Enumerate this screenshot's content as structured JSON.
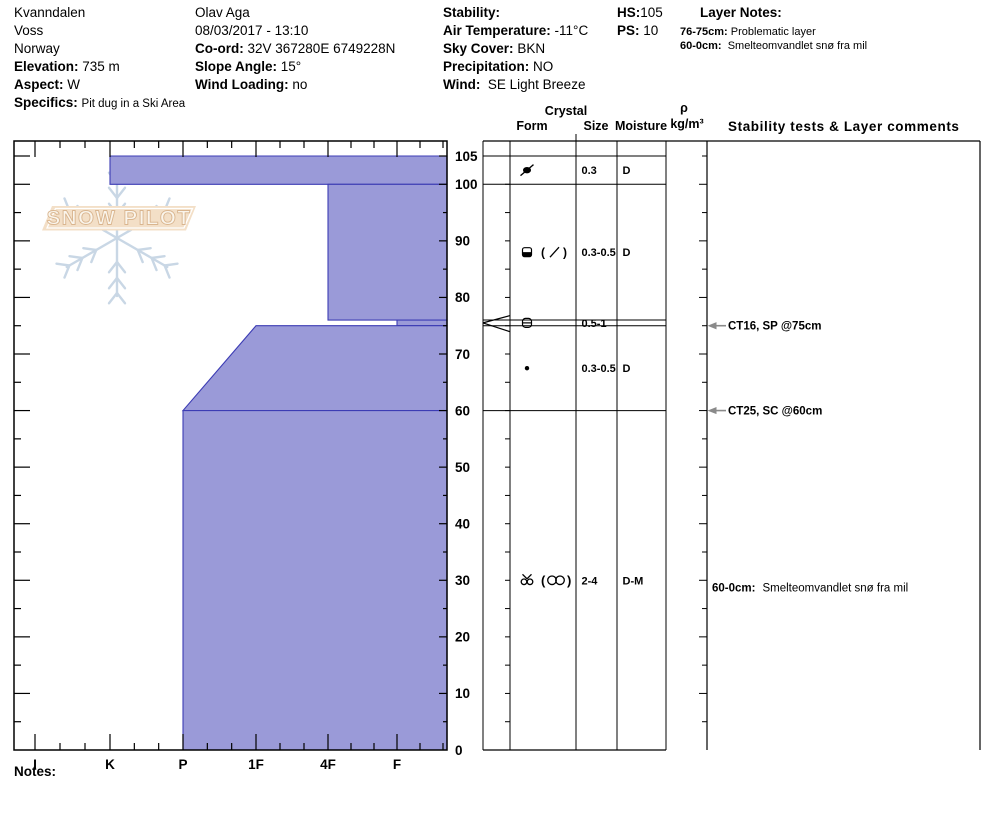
{
  "header": {
    "col1": {
      "line1": "Kvanndalen",
      "line2": "Voss",
      "line3": "Norway",
      "elevation_label": "Elevation:",
      "elevation": "735 m",
      "aspect_label": "Aspect:",
      "aspect": "W",
      "specifics_label": "Specifics:",
      "specifics": "Pit dug in a Ski Area"
    },
    "col2": {
      "observer": "Olav Aga",
      "datetime": "08/03/2017 - 13:10",
      "coord_label": "Co-ord:",
      "coord": "32V 367280E 6749228N",
      "slope_label": "Slope Angle:",
      "slope": "15°",
      "wind_loading_label": "Wind Loading:",
      "wind_loading": "no"
    },
    "col3": {
      "stability_label": "Stability:",
      "air_temp_label": "Air Temperature:",
      "air_temp": "-11°C",
      "sky_label": "Sky Cover:",
      "sky": "BKN",
      "precip_label": "Precipitation:",
      "precip": "NO",
      "wind_label": "Wind:",
      "wind": "SE Light Breeze"
    },
    "col4": {
      "hs_label": "HS:",
      "hs": "105",
      "ps_label": "PS:",
      "ps": "10"
    },
    "layer_notes": {
      "title": "Layer Notes:",
      "items": [
        {
          "range": "76-75cm:",
          "text": "Problematic layer"
        },
        {
          "range": "60-0cm:",
          "text": "Smelteomvandlet snø fra mil"
        }
      ]
    }
  },
  "table_headers": {
    "crystal": "Crystal",
    "form": "Form",
    "size": "Size",
    "moisture": "Moisture",
    "rho": "ρ",
    "rho_units": "kg/m³",
    "comments": "Stability tests & Layer comments"
  },
  "notes_label": "Notes:",
  "chart_data": {
    "type": "area",
    "subtype": "snow-hardness-profile",
    "title": "",
    "ylabel": "depth (cm)",
    "xlabel": "hand hardness",
    "hs_cm": 105,
    "y_ticks": [
      0,
      10,
      20,
      30,
      40,
      50,
      60,
      70,
      80,
      90,
      100,
      105
    ],
    "hardness_categories": [
      "I",
      "K",
      "P",
      "1F",
      "4F",
      "F"
    ],
    "grid": false,
    "legend": "none",
    "layers": [
      {
        "top_cm": 105,
        "bottom_cm": 100,
        "hardness": "K",
        "form": "decomposing-fragments",
        "form_secondary": "",
        "size": "0.3",
        "moisture": "D",
        "flagged": false
      },
      {
        "top_cm": 100,
        "bottom_cm": 76,
        "hardness": "4F",
        "form": "wind-packed",
        "form_secondary": "slash-in-parens",
        "size": "0.3-0.5",
        "moisture": "D",
        "flagged": false
      },
      {
        "top_cm": 76,
        "bottom_cm": 75,
        "hardness": "F",
        "form": "crust",
        "form_secondary": "",
        "size": "0.5-1",
        "moisture": "",
        "flagged": true
      },
      {
        "top_cm": 75,
        "bottom_cm": 60,
        "hardness": "1F",
        "hardness_bottom": "P",
        "form": "rounded-grains",
        "form_secondary": "",
        "size": "0.3-0.5",
        "moisture": "D",
        "flagged": false
      },
      {
        "top_cm": 60,
        "bottom_cm": 0,
        "hardness": "P",
        "form": "melt-cluster",
        "form_secondary": "double-circle-in-parens",
        "size": "2-4",
        "moisture": "D-M",
        "flagged": false
      }
    ],
    "stability_tests": [
      {
        "depth_cm": 75,
        "label": "CT16, SP @75cm"
      },
      {
        "depth_cm": 60,
        "label": "CT25, SC @60cm"
      }
    ],
    "layer_comments": [
      {
        "depth_cm": 30,
        "range": "60-0cm:",
        "text": "Smelteomvandlet snø fra mil"
      }
    ],
    "colors": {
      "layer_fill": "#9a9ad8",
      "layer_border": "#3c3cb4",
      "axis": "#000000",
      "arrow": "#8a8a8a",
      "watermark_flake": "#c9d7e5",
      "watermark_banner": "#f3dfc7",
      "watermark_text_stroke": "#d9b58f"
    },
    "watermark": {
      "text": "SNOW PILOT"
    }
  }
}
